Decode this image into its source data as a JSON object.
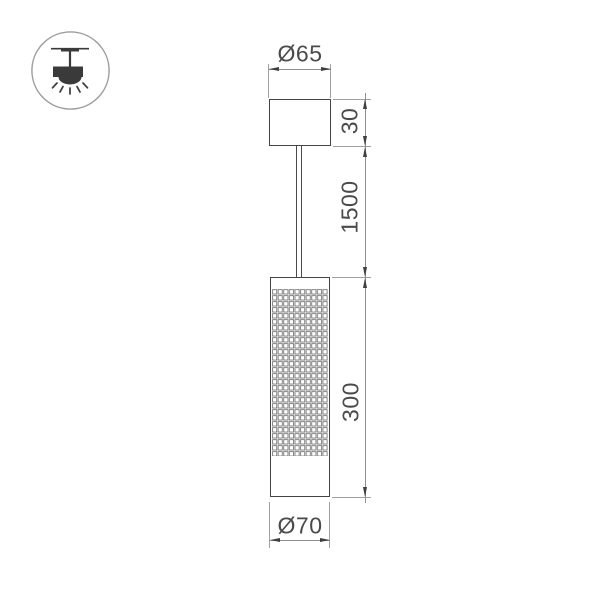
{
  "drawing": {
    "type": "pendant-luminaire-dimension-diagram",
    "labels": {
      "top_diameter": "Ø65",
      "canopy_height": "30",
      "suspension_length": "1500",
      "body_height": "300",
      "bottom_diameter": "Ø70"
    },
    "icons": {
      "mount": "ceiling-pendant-mount-icon"
    },
    "colors": {
      "object_line": "#454545",
      "dimension_line": "#8f8f8f",
      "text": "#4a4a4a",
      "icon_fill": "#3a3a3a",
      "background": "#ffffff"
    }
  }
}
